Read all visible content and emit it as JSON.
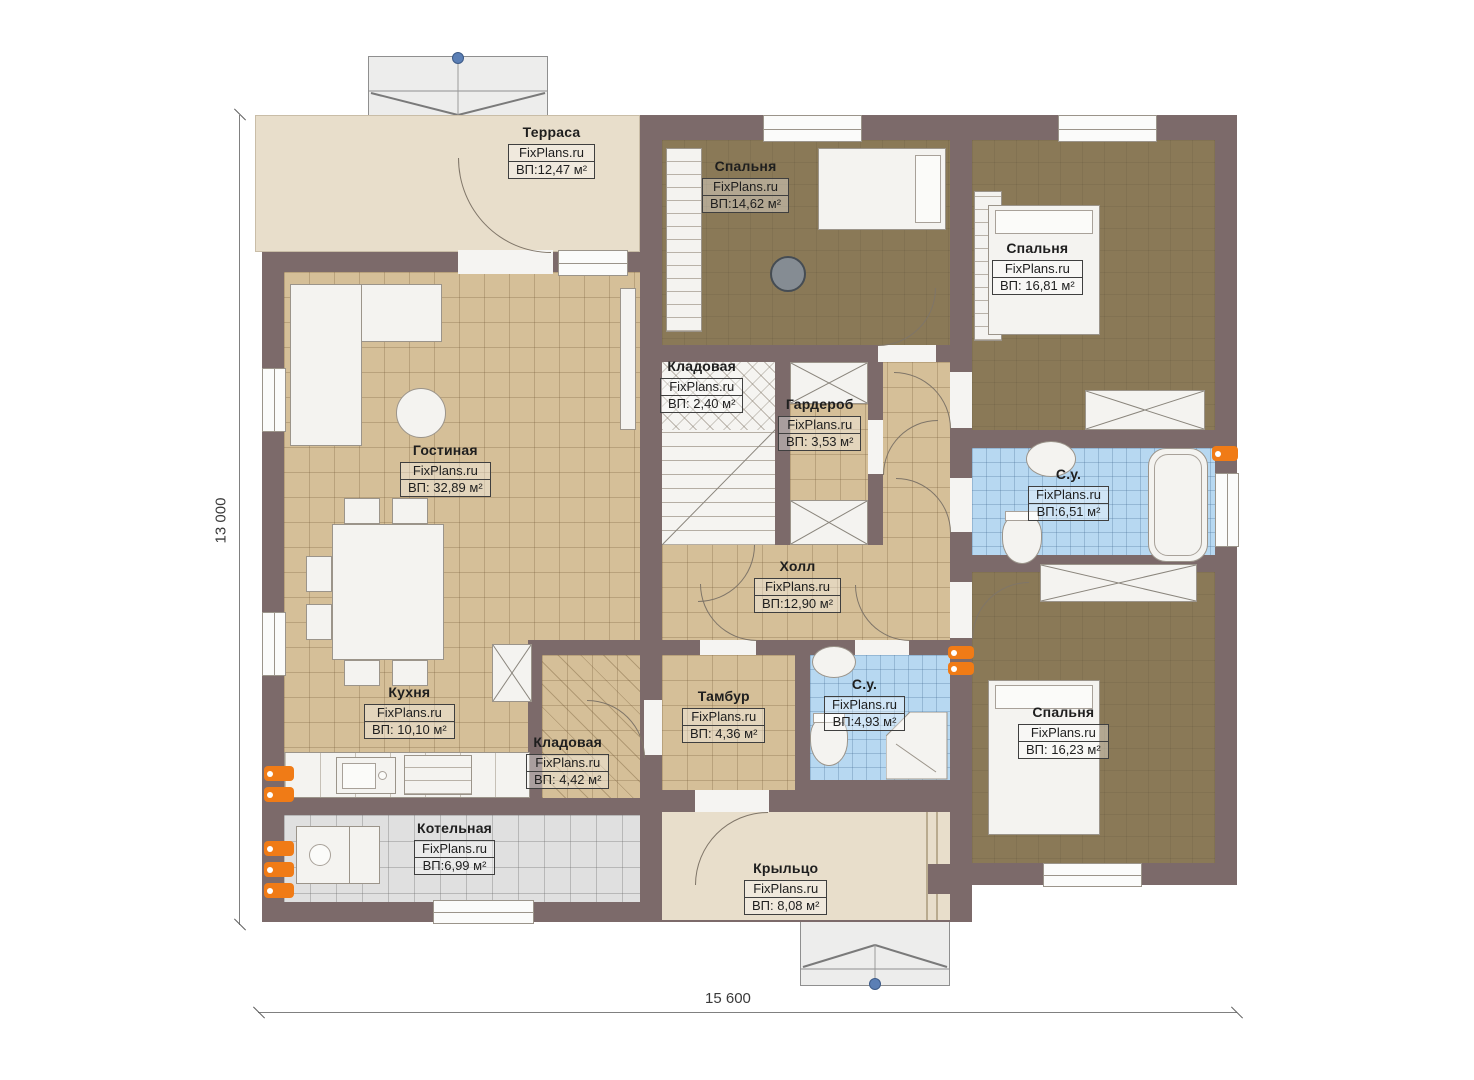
{
  "watermark": "FixPlans.ru",
  "dimensions": {
    "height_label": "13 000",
    "width_label": "15 600"
  },
  "colors": {
    "wall": "#7c6a6a",
    "floor_tan": "#d5bf98",
    "floor_brown": "#8a7957",
    "floor_blue": "#b7d8f1",
    "floor_gray": "#e0e0e0",
    "floor_beige": "#e8decb",
    "radiator": "#f07b16",
    "marker_blue": "#5b7fb5"
  },
  "rooms": {
    "terrace": {
      "name": "Терраса",
      "area": "ВП:12,47 м²"
    },
    "bedroom_top": {
      "name": "Спальня",
      "area": "ВП:14,62 м²"
    },
    "bedroom_right_top": {
      "name": "Спальня",
      "area": "ВП: 16,81 м²"
    },
    "storage_small": {
      "name": "Кладовая",
      "area": "ВП: 2,40 м²"
    },
    "wardrobe": {
      "name": "Гардероб",
      "area": "ВП: 3,53 м²"
    },
    "living": {
      "name": "Гостиная",
      "area": "ВП: 32,89 м²"
    },
    "hall": {
      "name": "Холл",
      "area": "ВП:12,90 м²"
    },
    "bath_top": {
      "name": "С.у.",
      "area": "ВП:6,51 м²"
    },
    "kitchen": {
      "name": "Кухня",
      "area": "ВП: 10,10 м²"
    },
    "storage_kitchen": {
      "name": "Кладовая",
      "area": "ВП: 4,42 м²"
    },
    "tambour": {
      "name": "Тамбур",
      "area": "ВП: 4,36 м²"
    },
    "bath_bottom": {
      "name": "С.у.",
      "area": "ВП:4,93 м²"
    },
    "bedroom_right_bottom": {
      "name": "Спальня",
      "area": "ВП: 16,23 м²"
    },
    "boiler": {
      "name": "Котельная",
      "area": "ВП:6,99 м²"
    },
    "porch": {
      "name": "Крыльцо",
      "area": "ВП: 8,08 м²"
    }
  }
}
